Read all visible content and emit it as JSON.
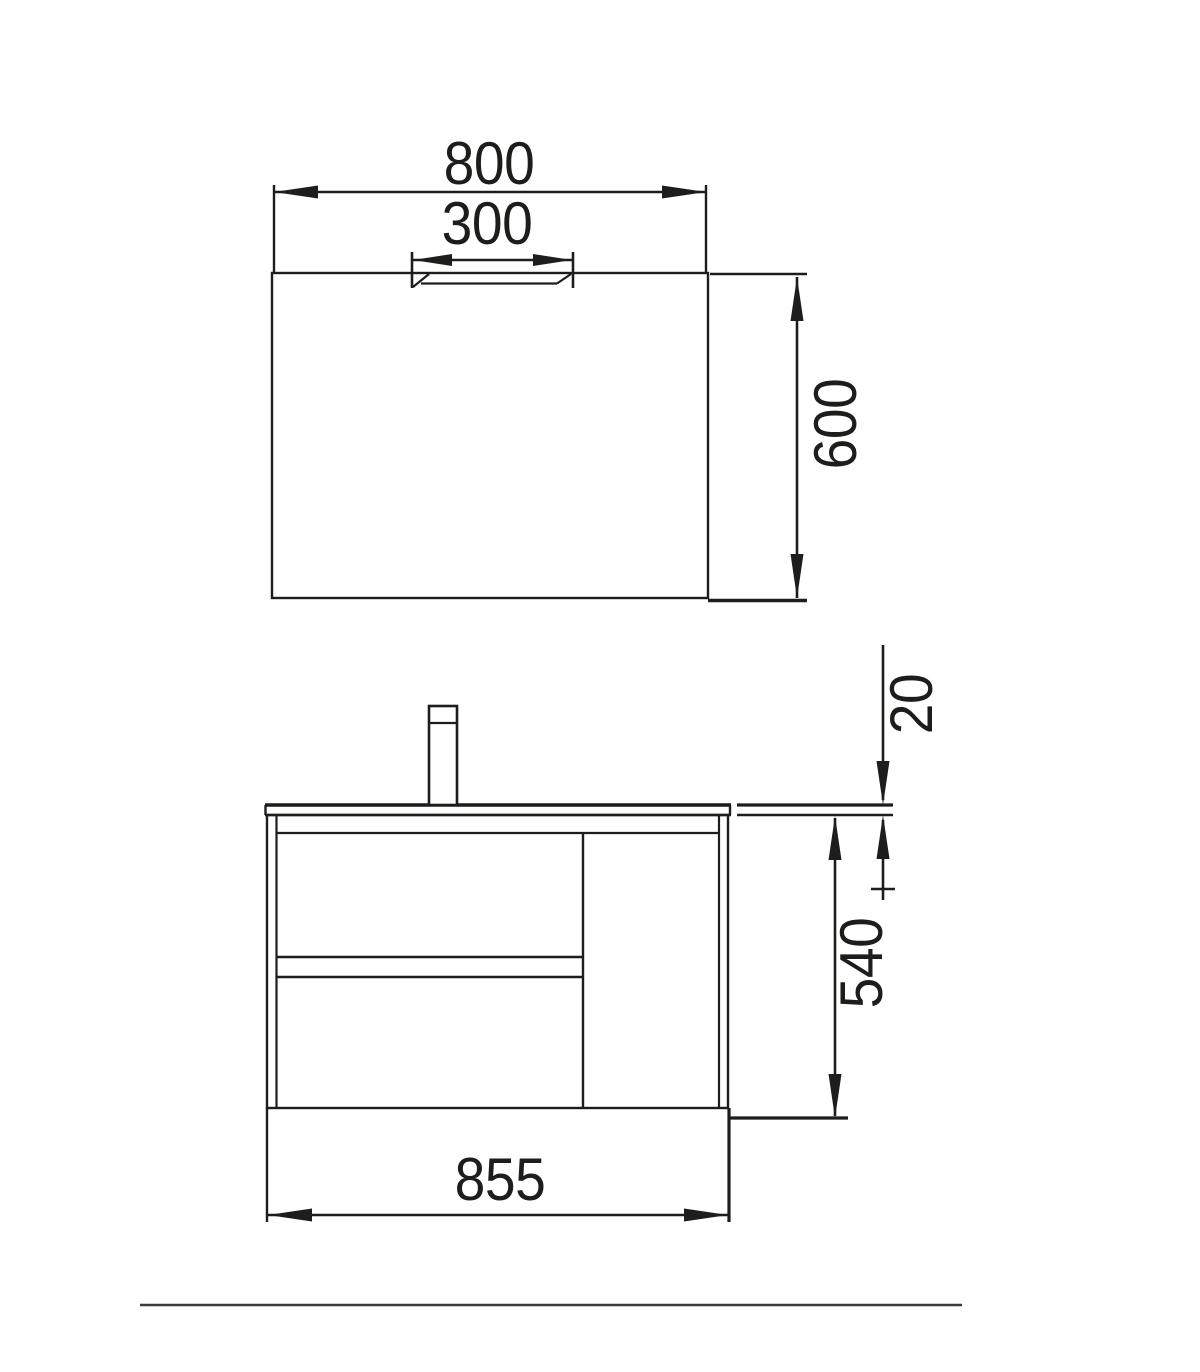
{
  "diagram": {
    "type": "furniture-dimension-drawing",
    "background_color": "#ffffff",
    "line_color": "#1d1d1b",
    "footer_line_color": "#3a3a3a",
    "mirror_view": {
      "width_label": "800",
      "light_width_label": "300",
      "height_label": "600"
    },
    "vanity_view": {
      "countertop_thickness_label": "20",
      "cabinet_height_label": "540",
      "overall_width_label": "855"
    }
  }
}
